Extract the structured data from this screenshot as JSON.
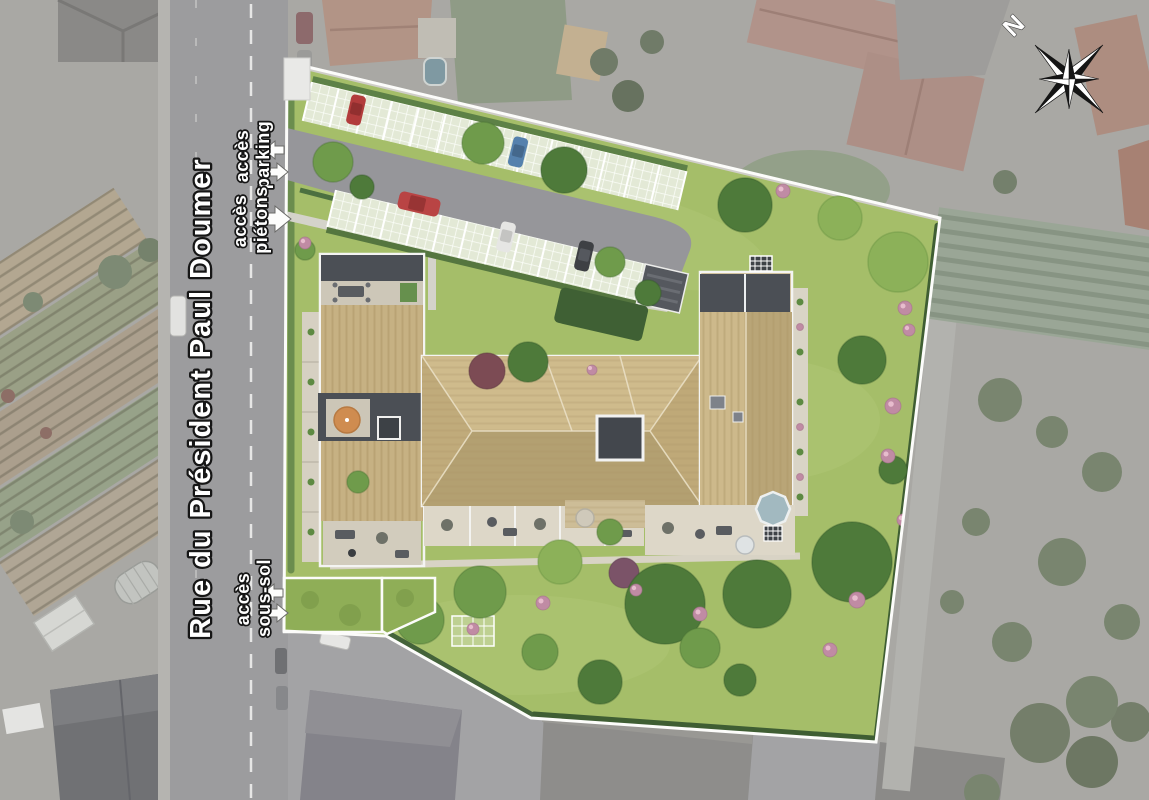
{
  "site_plan": {
    "street": {
      "name": "Rue du Président Paul Doumer"
    },
    "access_labels": {
      "parking": {
        "line1": "accès",
        "line2": "parking"
      },
      "pedestrian": {
        "line1": "accès",
        "line2": "piétons"
      },
      "basement": {
        "line1": "accès",
        "line2": "sous-sol"
      }
    },
    "compass": {
      "north": "N"
    },
    "palette": {
      "lawn": "#a5be69",
      "roof_tan": "#c6b183",
      "roof_dark": "#4b4f55",
      "asphalt": "#96969a",
      "parking_pavers": "#e3e9d6",
      "boundary": "#fcfcfa",
      "terrace": "#d9d3c5",
      "pool": "#a2b9c0",
      "surroundings": "#a9a8a4"
    }
  }
}
